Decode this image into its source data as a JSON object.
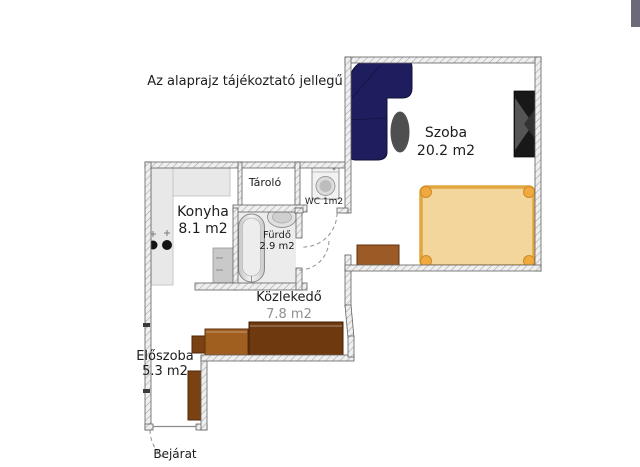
{
  "disclaimer": "Az alaprajz tájékoztató jellegű",
  "rooms": {
    "szoba": {
      "name": "Szoba",
      "area": "20.2 m2"
    },
    "konyha": {
      "name": "Konyha",
      "area": "8.1 m2"
    },
    "tarolo": {
      "name": "Tároló"
    },
    "wc": {
      "name": "WC 1m2"
    },
    "furdo": {
      "name": "Fürdő",
      "area": "2.9 m2"
    },
    "kozlekedo": {
      "name": "Közlekedő",
      "area": "7.8 m2"
    },
    "eloszoba": {
      "name": "Előszoba",
      "area": "5.3 m2"
    }
  },
  "entrance": {
    "label": "Bejárat"
  },
  "colors": {
    "sofa_navy": "#1e1e5e",
    "table_gray": "#4f4f4f",
    "tv_black": "#181818",
    "bed_fill": "#f3d69c",
    "bed_frame": "#e2a640",
    "wardrobe_dark_brown": "#6e390e",
    "wardrobe_mid_brown": "#a05e1f",
    "wardrobe_brown": "#7a4113",
    "dresser_brown": "#9c5b26",
    "counter_gray": "#e8e8e8",
    "bath_floor": "#ececec"
  },
  "furniture": {
    "szoba": [
      "corner-sofa",
      "oval-table",
      "tv-cabinet",
      "double-bed",
      "dresser"
    ],
    "konyha": [
      "kitchen-counter",
      "cooktop",
      "base-cabinet"
    ],
    "furdo": [
      "bathtub",
      "washbasin"
    ],
    "wc": [
      "washing-machine"
    ],
    "kozlekedo": [
      "wardrobe-large",
      "wardrobe-medium",
      "wardrobe-small"
    ],
    "eloszoba": [
      "hall-wardrobe"
    ]
  }
}
